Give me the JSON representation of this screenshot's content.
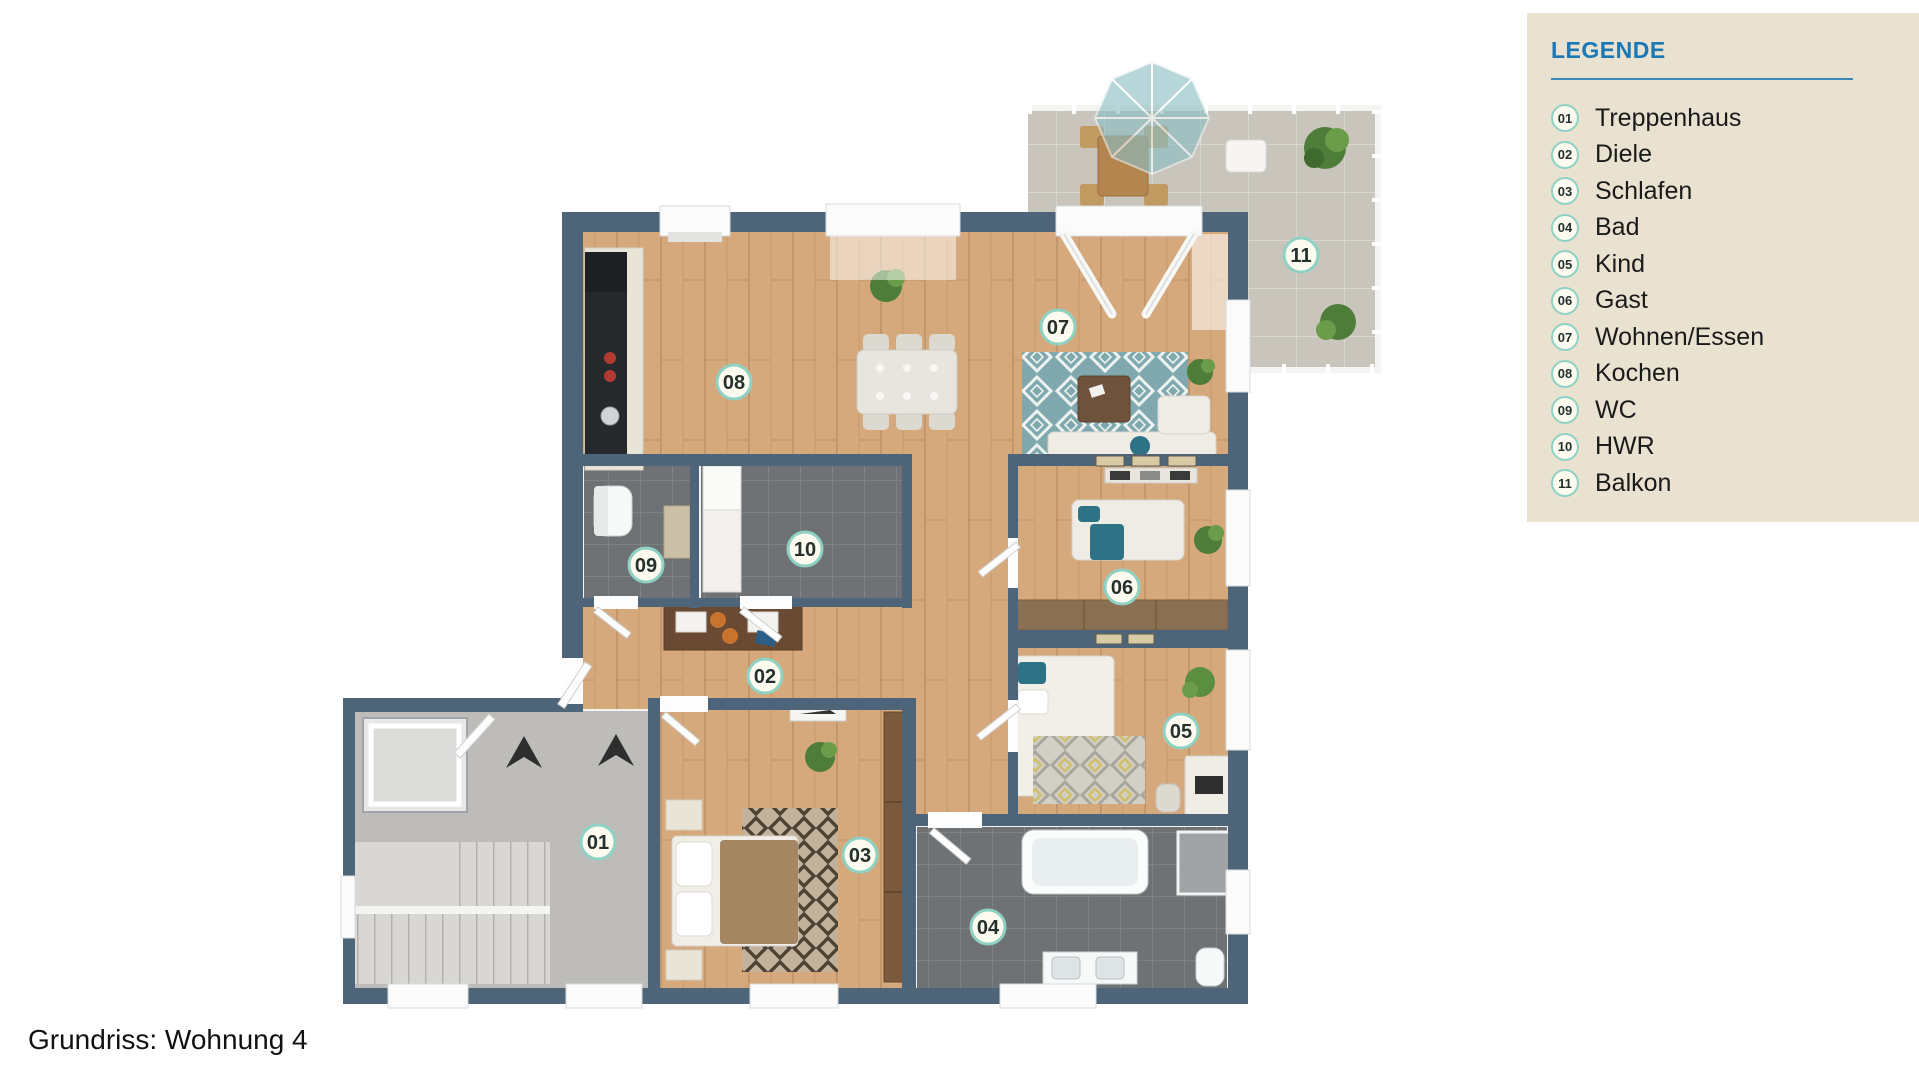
{
  "caption": "Grundriss: Wohnung 4",
  "legend": {
    "title": "LEGENDE",
    "items": [
      {
        "number": "01",
        "label": "Treppenhaus"
      },
      {
        "number": "02",
        "label": "Diele"
      },
      {
        "number": "03",
        "label": "Schlafen"
      },
      {
        "number": "04",
        "label": "Bad"
      },
      {
        "number": "05",
        "label": "Kind"
      },
      {
        "number": "06",
        "label": "Gast"
      },
      {
        "number": "07",
        "label": "Wohnen/Essen"
      },
      {
        "number": "08",
        "label": "Kochen"
      },
      {
        "number": "09",
        "label": "WC"
      },
      {
        "number": "10",
        "label": "HWR"
      },
      {
        "number": "11",
        "label": "Balkon"
      }
    ]
  },
  "colors": {
    "wall": "#4e6479",
    "wood": "#d5a97c",
    "tile-dark": "#6f7274",
    "tile-light": "#c9c5bc",
    "concrete": "#bdbcb9",
    "stair": "#d8d7d4",
    "panel": "#e9e2d1",
    "accent": "#1a78b4",
    "badge-ring": "#8fd2c4",
    "badge-fill": "#fdfaef",
    "teal": "#2e7286",
    "brown-dark": "#7b5a3e",
    "brown-mid": "#8a6f52",
    "text-dark": "#1a1a1a"
  }
}
